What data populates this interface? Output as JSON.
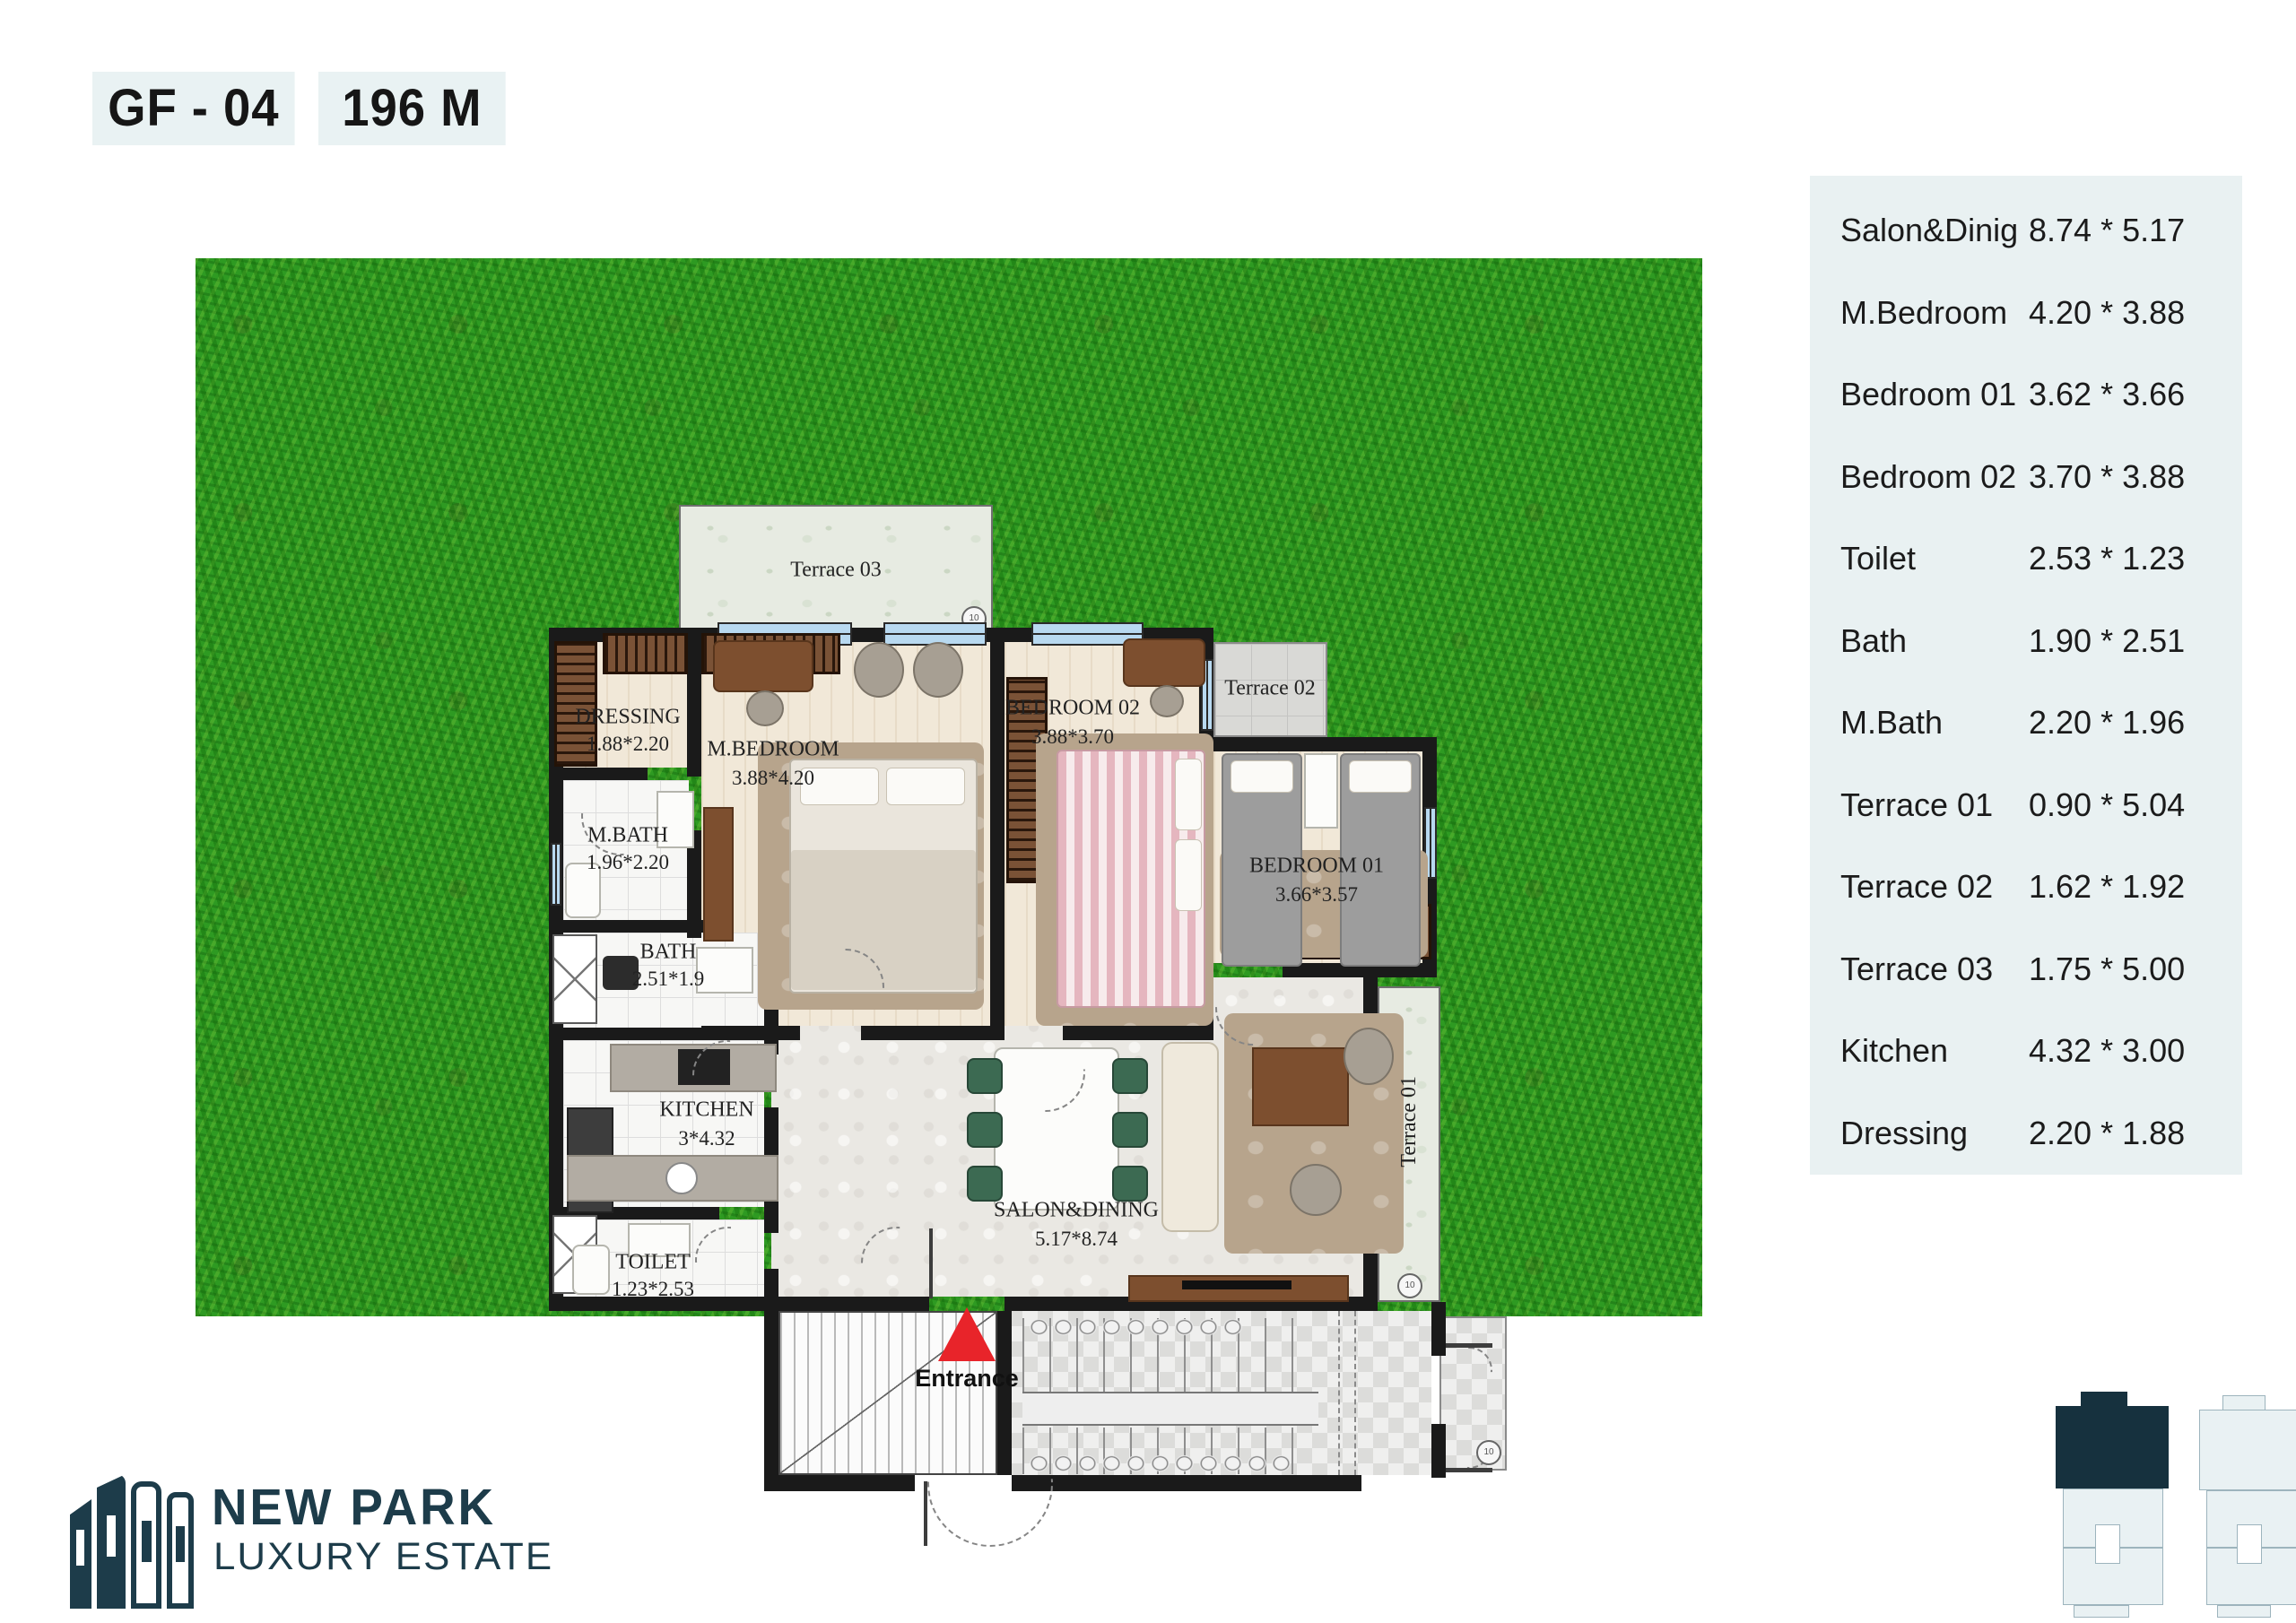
{
  "header": {
    "unit": "GF - 04",
    "area": "196 M"
  },
  "rooms_table": {
    "rows": [
      {
        "name": "Salon&Dinig",
        "dim": "8.74 * 5.17"
      },
      {
        "name": "M.Bedroom",
        "dim": "4.20 * 3.88"
      },
      {
        "name": "Bedroom 01",
        "dim": "3.62 * 3.66"
      },
      {
        "name": "Bedroom 02",
        "dim": "3.70 * 3.88"
      },
      {
        "name": "Toilet",
        "dim": "2.53 * 1.23"
      },
      {
        "name": "Bath",
        "dim": "1.90 * 2.51"
      },
      {
        "name": "M.Bath",
        "dim": "2.20 * 1.96"
      },
      {
        "name": "Terrace 01",
        "dim": "0.90 * 5.04"
      },
      {
        "name": "Terrace 02",
        "dim": "1.62 * 1.92"
      },
      {
        "name": "Terrace 03",
        "dim": "1.75 * 5.00"
      },
      {
        "name": "Kitchen",
        "dim": "4.32 * 3.00"
      },
      {
        "name": "Dressing",
        "dim": "2.20 * 1.88"
      }
    ]
  },
  "plan": {
    "terrace03_label": "Terrace 03",
    "terrace02_label": "Terrace 02",
    "terrace01_label": "Terrace 01",
    "entrance_label": "Entrance",
    "grid_marker": "10",
    "rooms": {
      "dressing": {
        "name": "DRESSING",
        "dim": "1.88*2.20"
      },
      "mbath": {
        "name": "M.BATH",
        "dim": "1.96*2.20"
      },
      "bath": {
        "name": "BATH",
        "dim": "2.51*1.9"
      },
      "kitchen": {
        "name": "KITCHEN",
        "dim": "3*4.32"
      },
      "toilet": {
        "name": "TOILET",
        "dim": "1.23*2.53"
      },
      "mbedroom": {
        "name": "M.BEDROOM",
        "dim": "3.88*4.20"
      },
      "bedroom02": {
        "name": "BEDROOM 02",
        "dim": "3.88*3.70"
      },
      "bedroom01": {
        "name": "BEDROOM 01",
        "dim": "3.66*3.57"
      },
      "salon": {
        "name": "SALON&DINING",
        "dim": "5.17*8.74"
      }
    }
  },
  "logo": {
    "name": "NEW PARK",
    "tagline": "LUXURY ESTATE"
  },
  "colors": {
    "accent_dark": "#1d3c4a",
    "entrance_red": "#e8242a",
    "badge_bg": "#e9f2f3",
    "table_bg": "#e9f1f2",
    "grass": "#2e9a22"
  }
}
